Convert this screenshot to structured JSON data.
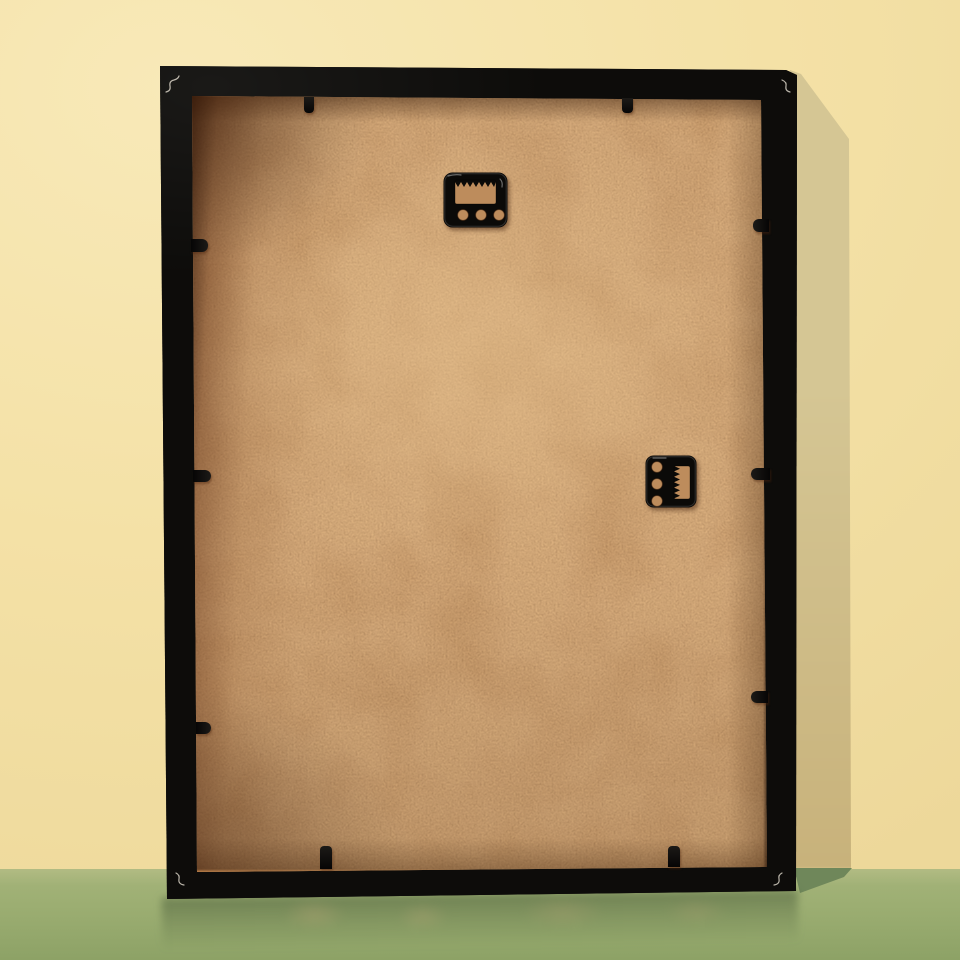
{
  "scene": {
    "subject": "Back view of a black picture frame leaning against a yellow wall on a green floor",
    "wall": {
      "label": "yellow wall"
    },
    "floor": {
      "label": "green floor with soft reflection of the frame"
    },
    "shadow": {
      "label": "soft shadow cast by the frame on wall and floor"
    },
    "frame": {
      "label": "black picture frame, back side"
    },
    "backing": {
      "label": "tan MDF hardboard backing panel"
    },
    "hangers": [
      {
        "label": "black sawtooth hanger plate, horizontal, 3 screw holes",
        "position": "top-center"
      },
      {
        "label": "black sawtooth hanger plate, vertical, 3 screw holes",
        "position": "middle-right"
      }
    ],
    "tabs": {
      "label": "black metal retainer tab",
      "count": 10
    },
    "scuffs": {
      "label": "light scuff mark on frame corner",
      "count": 4
    }
  },
  "colors": {
    "wall": "#f4e1a6",
    "wall_light": "#f8e9b8",
    "wall_dark": "#edd89a",
    "wall_shadow": "#d5c694",
    "wall_shadow_deep": "#c8b27b",
    "floor": "#9cae72",
    "floor_light": "#a5b47a",
    "floor_dark": "#8da266",
    "floor_shadow": "#6f875a",
    "frame": "#0d0c0a",
    "frame_hi": "#1b1914",
    "backing": "#cb9c6a",
    "backing_light": "#ecc392",
    "backing_dark": "#6f4322",
    "hardware": "#0b0a08",
    "hole": "#bd8c5c",
    "scuff": "#e6e0d2"
  }
}
